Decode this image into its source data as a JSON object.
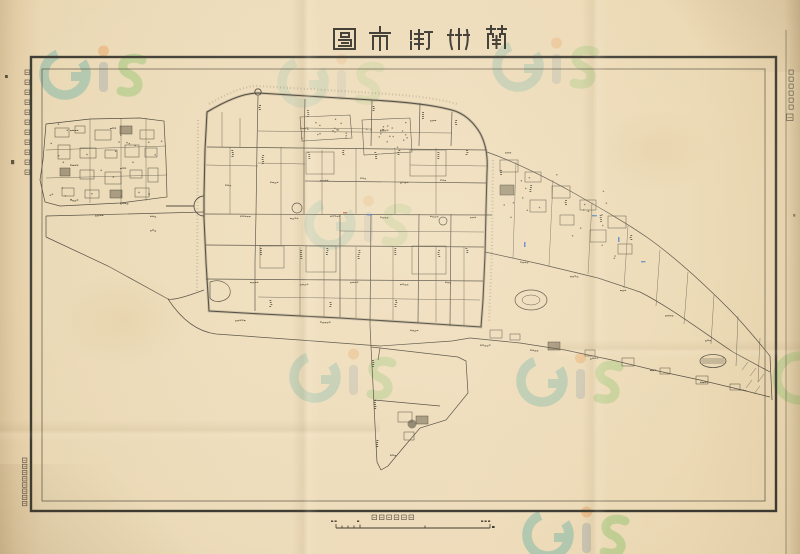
{
  "sheet": {
    "kind": "scanned historical map sheet",
    "title": {
      "text": "蘭州街市圖",
      "romanized": "Lanzhou Jieshi Tu (Lanzhou Street Map)",
      "script_style": "seal-script, read right to left"
    },
    "left_margin_note": {
      "text": "中華民國二十五年十月調製",
      "approximate": true,
      "orientation": "vertical"
    },
    "right_margin_note": {
      "text": "",
      "legible": false,
      "description": "six tiny vertical characters followed by one larger character",
      "orientation": "vertical"
    },
    "bottom_left_imprint": {
      "text": "",
      "legible": false,
      "description": "column of eight tiny printed characters outside border",
      "orientation": "vertical"
    },
    "scale": {
      "label": "五千分一之尺",
      "legible": false,
      "description": "graphic scale bar with subdivided left end and tiny end numerals"
    }
  },
  "map": {
    "type": "historical-city-street-map",
    "features": [
      {
        "name": "walled-city",
        "description": "central walled city with dense street grid"
      },
      {
        "name": "north-gate",
        "description": "small circular gate mark on north wall"
      },
      {
        "name": "west-gate-loop",
        "description": "half-circle road loop at west wall"
      },
      {
        "name": "western-suburb-block",
        "description": "built-up quarter outside west wall"
      },
      {
        "name": "eastern-suburb-strip",
        "description": "long road strip sloping to south-east corner"
      },
      {
        "name": "southern-road-spur",
        "description": "road running south with small settlement"
      },
      {
        "name": "oval-enclosure",
        "description": "small oval track east of city"
      },
      {
        "name": "pond",
        "description": "hatched pond near south-east strip"
      },
      {
        "name": "tree-dotted-parks",
        "description": "dot-textured compounds inside north city"
      }
    ],
    "annotations": {
      "ink_marks": "a few small blue and red hand annotations"
    }
  },
  "watermark": {
    "text": "GiS",
    "description": "repeating translucent logo watermark over the scan",
    "colors": {
      "g": "#2e9f9b",
      "i_stem": "#7b95a6",
      "i_dot": "#e8832a",
      "s": "#5cb847"
    }
  },
  "colors": {
    "paper": "#ecdab6",
    "paper_edge": "#d6bf97",
    "map_line": "#4a4438",
    "wall_line": "#3f3b30",
    "border": "#3c3a31",
    "annotation_blue": "#3a6fc4",
    "annotation_red": "#c05434"
  }
}
